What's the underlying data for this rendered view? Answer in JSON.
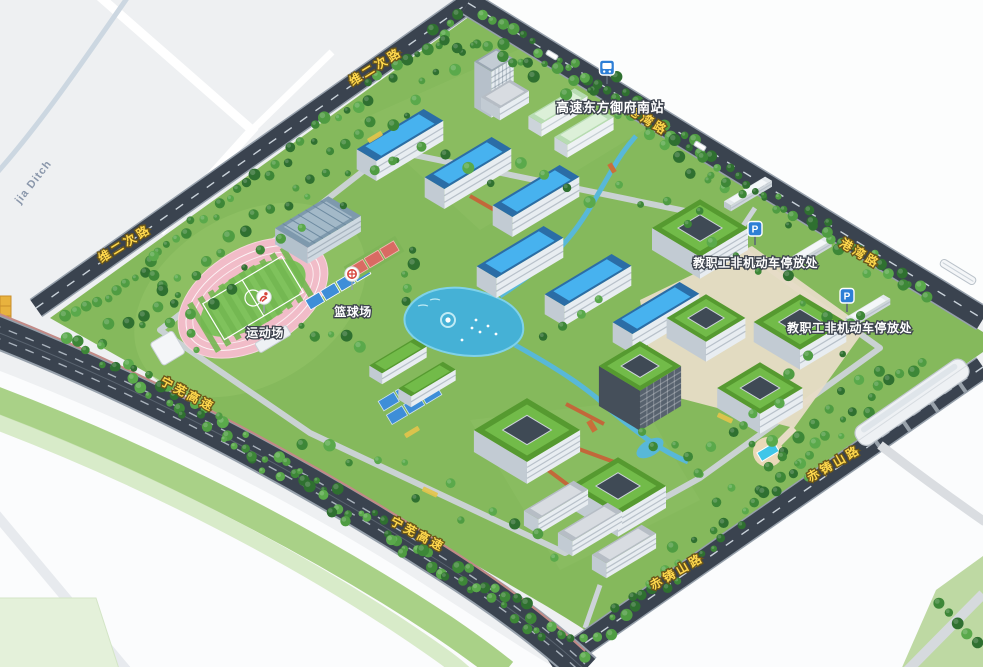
{
  "map_labels": {
    "bus_stop_name": "高速东方御府南站",
    "staff_parking_1": "教职工非机动车停放处",
    "staff_parking_2": "教职工非机动车停放处",
    "sports_field": "运动场",
    "basketball_court": "篮球场",
    "parking_icon_letter": "P"
  },
  "roads": {
    "north_road": "维二次路",
    "east_road": "港湾路",
    "southeast_road": "赤铸山路",
    "southwest_expressway": "宁芜高速",
    "ditch_label": "jia Ditch"
  },
  "colors": {
    "road_label_yellow": "#ffd84d",
    "poi_label_white": "#ffffff",
    "sign_blue": "#2e7fd6",
    "campus_green": "#85b95c",
    "water_blue": "#45b1d6",
    "track_pink": "#f0b9c6",
    "road_dark": "#3a434f"
  }
}
